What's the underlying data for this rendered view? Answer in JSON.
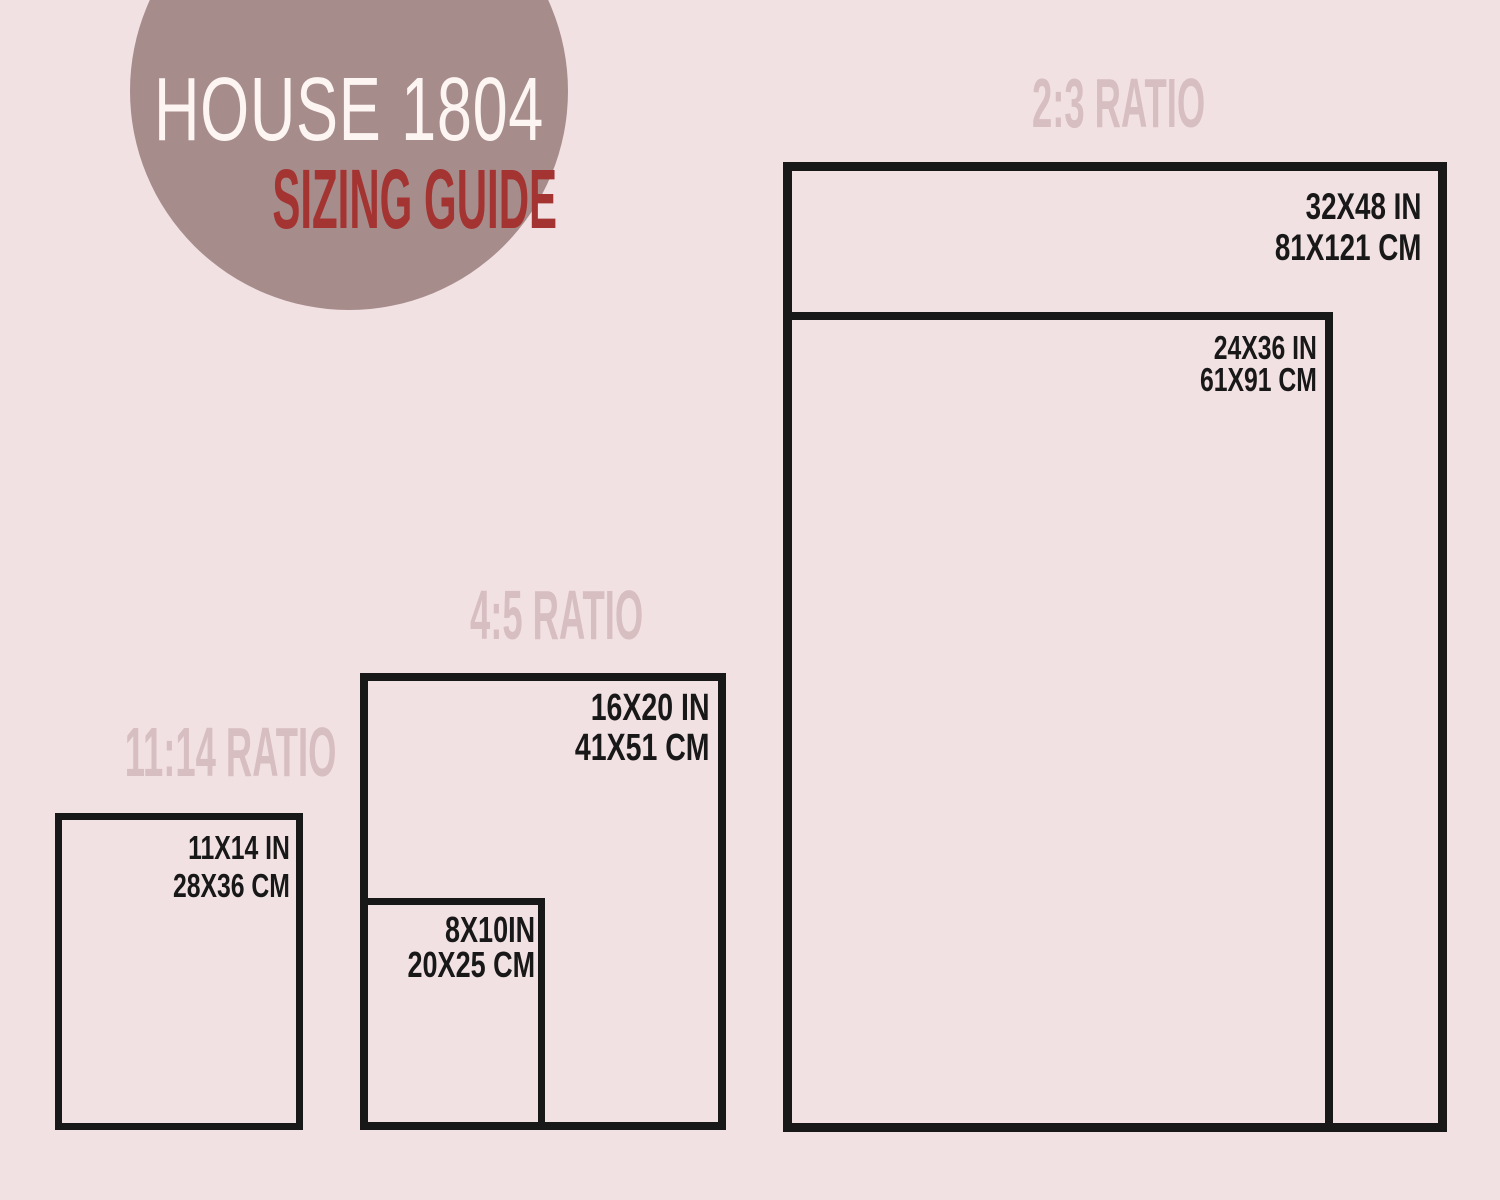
{
  "page": {
    "background_color": "#f2e1e3",
    "frame_border_color": "#181818",
    "label_color": "#181818",
    "heading_color": "#d7bec0"
  },
  "logo": {
    "circle_color": "#a78c8c",
    "title_left": "HOUSE",
    "title_right": "1804",
    "title_color": "#fcf5f2",
    "subtitle": "SIZING GUIDE",
    "subtitle_color": "#a43431"
  },
  "groups": [
    {
      "ratio_label": "2:3 RATIO",
      "sizes": [
        {
          "in": "32X48 IN",
          "cm": "81X121 CM"
        },
        {
          "in": "24X36 IN",
          "cm": "61X91 CM"
        }
      ]
    },
    {
      "ratio_label": "4:5 RATIO",
      "sizes": [
        {
          "in": "16X20 IN",
          "cm": "41X51 CM"
        },
        {
          "in": "8X10IN",
          "cm": "20X25 CM"
        }
      ]
    },
    {
      "ratio_label": "11:14 RATIO",
      "sizes": [
        {
          "in": "11X14 IN",
          "cm": "28X36 CM"
        }
      ]
    }
  ]
}
